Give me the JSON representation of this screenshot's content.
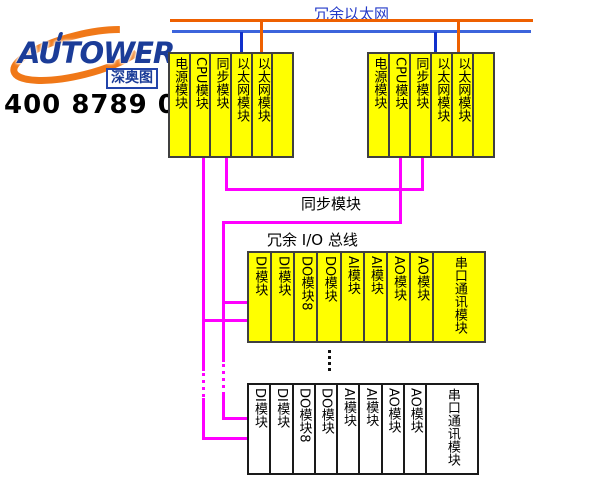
{
  "branding": {
    "logo_text": "AUTOWER",
    "logo_sub": "深奥图",
    "phone": "400 8789 055"
  },
  "labels": {
    "redundant_ethernet": "冗余以太网",
    "sync_link": "同步模块",
    "redundant_io_bus": "冗余 I/O 总线"
  },
  "cpu_rack": {
    "modules": [
      "电源模块",
      "CPU模块",
      "同步模块",
      "以太网模块",
      "以太网模块",
      ""
    ]
  },
  "io_rack": {
    "modules": [
      "DI模块",
      "DI模块",
      "DO模块8",
      "DO模块",
      "AI模块",
      "AI模块",
      "AO模块",
      "AO模块",
      "串口通讯模块"
    ]
  },
  "colors": {
    "ethernet_line_a": "#EE6000",
    "ethernet_line_b": "#3C64DC",
    "ethernet_drop_b": "#1030CC",
    "bus_magenta": "#FF00FF",
    "module_yellow": "#FFFF00",
    "module_border": "#404040",
    "logo_blue": "#1B3C98",
    "logo_orange": "#F07818"
  }
}
